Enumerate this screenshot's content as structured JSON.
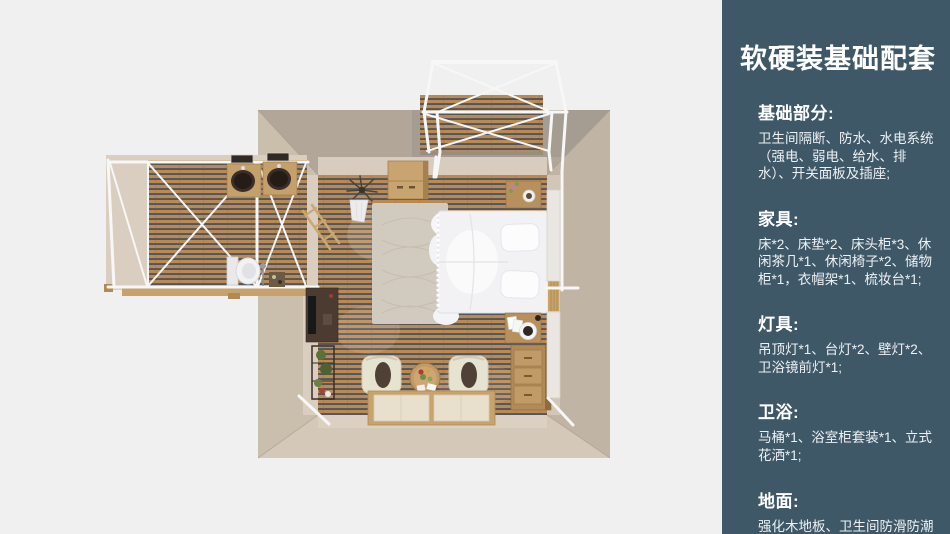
{
  "panel": {
    "title": "软硬装基础配套",
    "sections": [
      {
        "heading": "基础部分:",
        "body": "卫生间隔断、防水、水电系统（强电、弱电、给水、排水）、开关面板及插座;"
      },
      {
        "heading": "家具:",
        "body": "床*2、床垫*2、床头柜*3、休闲茶几*1、休闲椅子*2、储物柜*1，衣帽架*1、梳妆台*1;"
      },
      {
        "heading": "灯具:",
        "body": "吊顶灯*1、台灯*2、壁灯*2、卫浴镜前灯*1;"
      },
      {
        "heading": "卫浴:",
        "body": "马桶*1、浴室柜套装*1、立式花洒*1;"
      },
      {
        "heading": "地面:",
        "body": "强化木地板、卫生间防滑防潮石塑板;"
      }
    ],
    "colors": {
      "panel_bg": "#3e5868",
      "heading_text": "#ffffff",
      "body_text": "#eef1f3"
    }
  },
  "floorplan": {
    "view": "top-down 3d render of bedroom suite with bathroom wing and balcony",
    "colors": {
      "backdrop": "#f0f0f0",
      "wall_outer": "#c4b8a8",
      "wall_inner_face": "#d7ccbd",
      "wood_plank": "#bb8a52",
      "wood_gap": "#50555e",
      "frame_white": "#f7f7f7",
      "bed_white": "#f2f2f4",
      "rug": "#cfc7ba"
    }
  }
}
